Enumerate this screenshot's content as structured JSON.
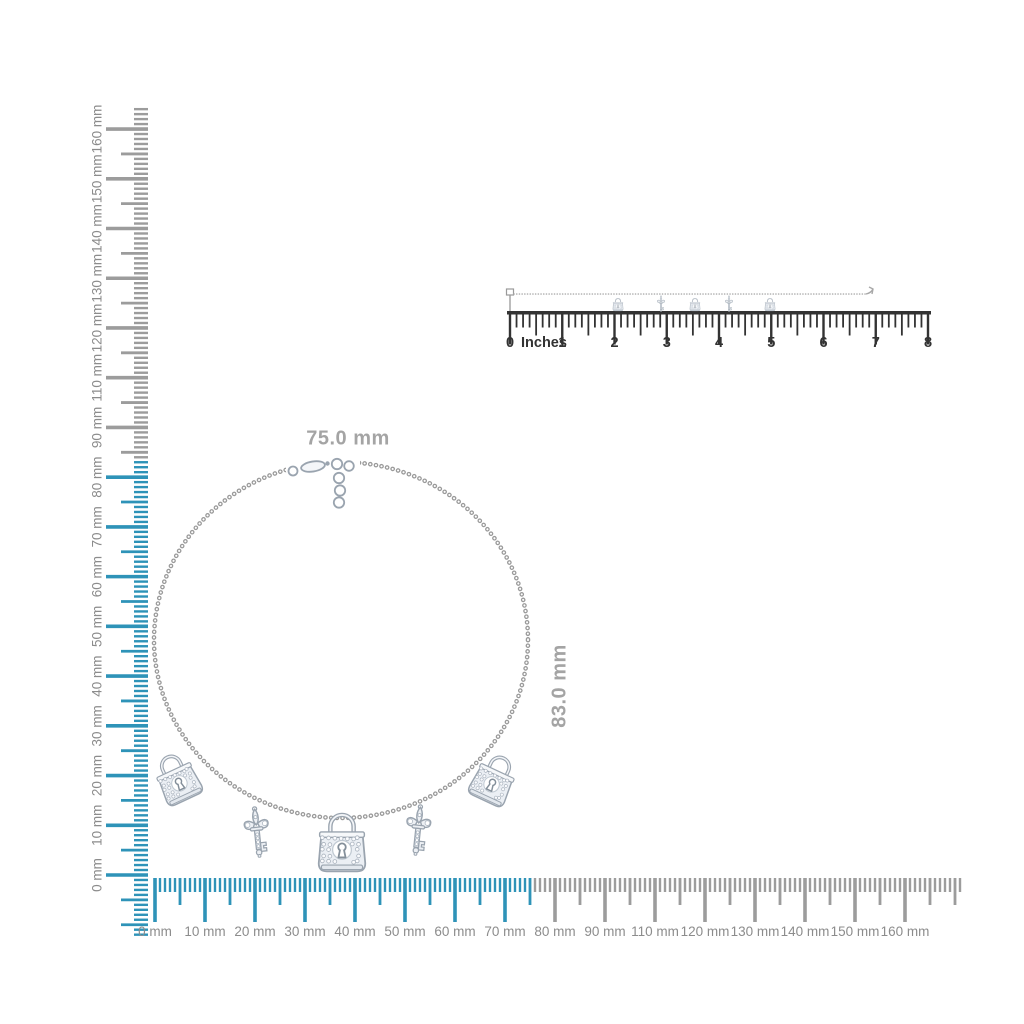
{
  "dimensions": {
    "width_label": "75.0 mm",
    "height_label": "83.0 mm"
  },
  "mm_rulers": {
    "labels": [
      "0 mm",
      "10 mm",
      "20 mm",
      "30 mm",
      "40 mm",
      "50 mm",
      "60 mm",
      "70 mm",
      "80 mm",
      "90 mm",
      "110 mm",
      "120 mm",
      "130 mm",
      "140 mm",
      "150 mm",
      "160 mm"
    ],
    "highlight_color": "#2E93B8",
    "tick_color": "#9C9C9C",
    "label_color": "#8C8C8C"
  },
  "inch_ruler": {
    "zero_label": "0",
    "unit_label": "Inches",
    "number_labels": [
      "1",
      "2",
      "3",
      "4",
      "5",
      "6",
      "7",
      "8"
    ],
    "color": "#333333"
  },
  "necklace": {
    "metal_color": "#9AA4AF",
    "charms": [
      "lock",
      "key",
      "lock",
      "key",
      "lock"
    ],
    "mini_charms": [
      "lock",
      "key",
      "lock",
      "key",
      "lock"
    ]
  }
}
